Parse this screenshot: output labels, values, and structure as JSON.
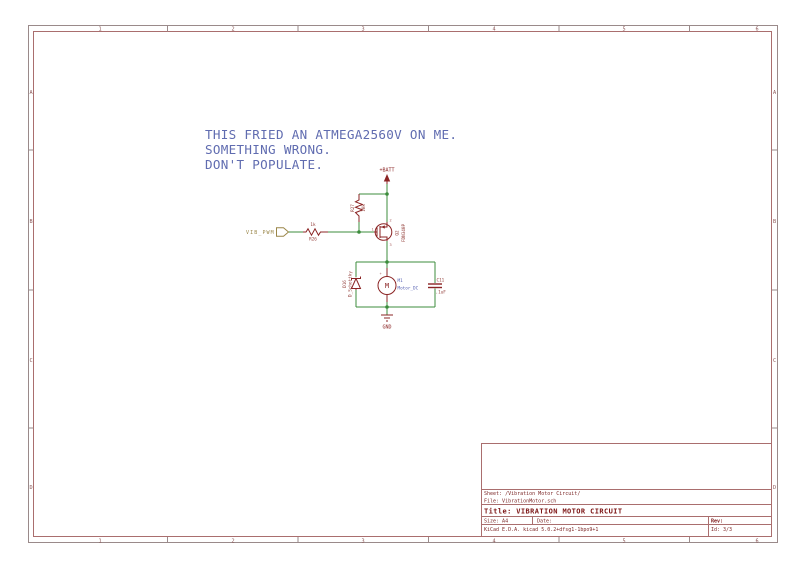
{
  "colors": {
    "wire_green": "#3c8c3c",
    "symbol_red": "#8b2424",
    "field_text": "#94403c",
    "motor_field_blue": "#5a64b4",
    "note_blue": "#606cb0",
    "hier_label_olive": "#9a8648",
    "frame_gray": "#9a8a8a",
    "frame_red": "#aa6e6e",
    "titleblock_text": "#7d2828"
  },
  "frame": {
    "columns": [
      "1",
      "2",
      "3",
      "4",
      "5",
      "6"
    ],
    "rows": [
      "A",
      "B",
      "C",
      "D"
    ]
  },
  "note": {
    "lines": [
      "THIS FRIED AN ATMEGA2560V ON ME.",
      "SOMETHING WRONG.",
      "DON'T POPULATE."
    ]
  },
  "schematic": {
    "vbatt": "+BATT",
    "gnd": "GND",
    "input_label": "VIB_PWM",
    "motor_letter": "M",
    "motor_plus": "+",
    "pins": {
      "q2_top": "2",
      "q2_gate": "1",
      "q2_bottom": "3"
    },
    "components": [
      {
        "ref": "R27",
        "value": "10k"
      },
      {
        "ref": "R26",
        "value": "1k"
      },
      {
        "ref": "Q2",
        "value": "FDN340P"
      },
      {
        "ref": "D16",
        "value": "D_Schottky"
      },
      {
        "ref": "M1",
        "value": "Motor_DC"
      },
      {
        "ref": "C11",
        "value": ".1uF"
      }
    ]
  },
  "title_block": {
    "sheet": "Sheet: /Vibration Motor Circuit/",
    "file": "File: VibrationMotor.sch",
    "title": "Title: VIBRATION MOTOR CIRCUIT",
    "size": "Size: A4",
    "date": "Date:",
    "generator": "KiCad E.D.A.  kicad 5.0.2+dfsg1-1bpo9+1",
    "rev": "Rev:",
    "id": "Id: 3/3"
  }
}
